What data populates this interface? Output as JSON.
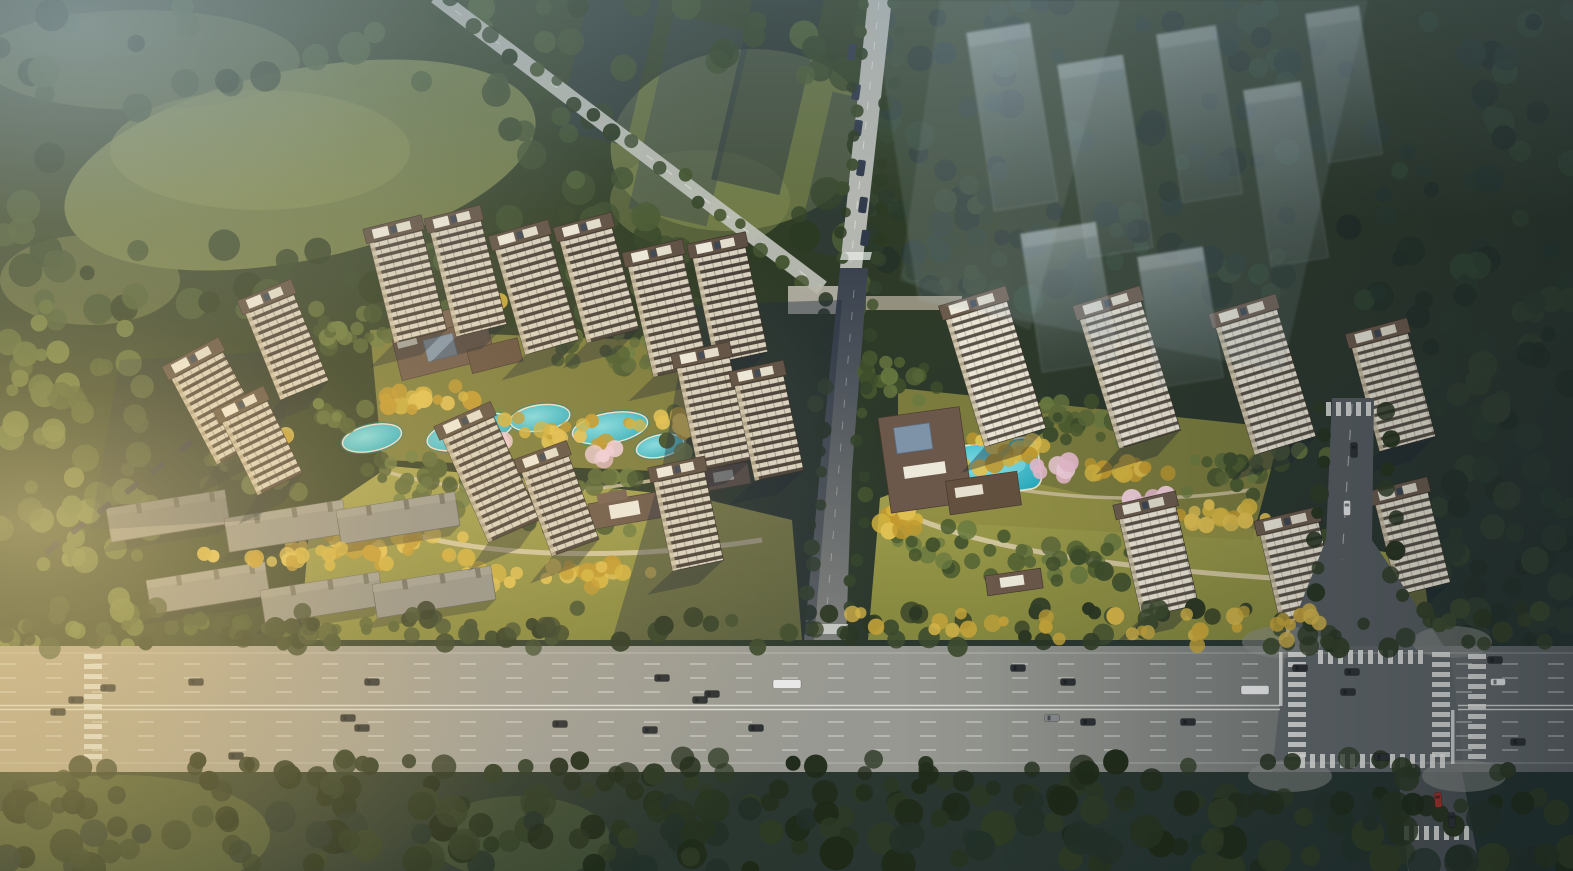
{
  "scene": {
    "kind": "aerial-architectural-rendering",
    "description": "Bird's-eye rendering of a two-phase residential compound: cream high-rise apartment slabs with brown roof decks arranged around landscaped courtyards with turquoise pools and golden autumn trees; a brown-roofed clubhouse in each phase; six grey low-rise buildings at the lower left; a wide multi-lane highway with traffic across the bottom; a signalized intersection at lower right; dense dark forest all around; translucent future-phase towers over the forest at the upper right; warm low sunlight entering from the left.",
    "counts": {
      "towers_left_phase": 14,
      "towers_right_phase": 7,
      "lowrise_buildings": 6,
      "ghost_future_buildings": 7,
      "pools": 3,
      "highway_lanes": 8,
      "vehicles_visible_approx": 40
    },
    "lighting": "warm low sun from the west, cool blue haze to the north-east"
  },
  "palette": {
    "forest_dark": "#26331f",
    "forest_mid": "#3c4c2c",
    "forest_light": "#5d6f3e",
    "forest_blue": "#2b3a31",
    "canopy_yellow": "#d2b23f",
    "canopy_gold": "#c1992f",
    "lawn": "#9c9c46",
    "field_olive": "#75804a",
    "pool_teal": "#2db6c8",
    "pool_teal_light": "#7fdbe4",
    "blossom_pink": "#e5bacb",
    "facade_cream": "#d8d1c0",
    "facade_band": "#49413a",
    "facade_bright": "#eae4d4",
    "roof_brown": "#5e5044",
    "roof_white": "#ece8da",
    "lowrise_grey": "#90908a",
    "road_light": "#b4b6b0",
    "road_mid": "#97978f",
    "road_dark": "#565c60",
    "asphalt_shadow": "#3e4650",
    "marking_white": "#e9eae6",
    "ghost_blue": "#9cb0c0",
    "haze_blue": "#8fa3ad",
    "sun_warm": "#ffe2a0",
    "shadow_blue": "#1c2432",
    "car_dark": "#2c3034",
    "car_white": "#e8e9ea",
    "car_red": "#a23028"
  }
}
